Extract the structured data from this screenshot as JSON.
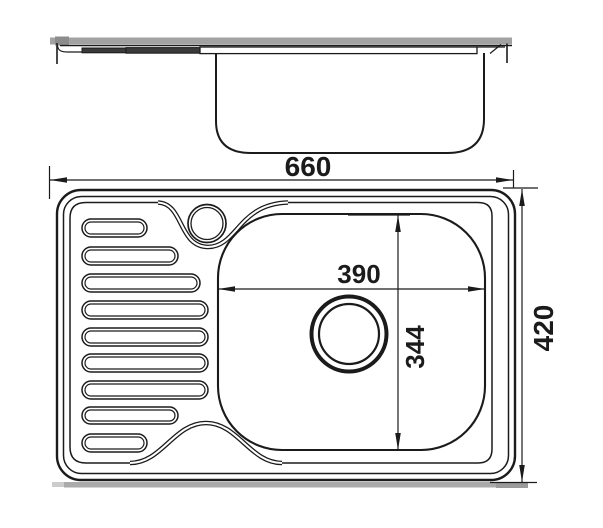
{
  "drawing": {
    "subject": "kitchen-sink-with-drainboard",
    "views": {
      "side_view": "sink profile with bowl cross-section",
      "top_view": "sink plan with drainboard, faucet hole and drain"
    },
    "dimensions": {
      "overall_width": "660",
      "overall_depth": "420",
      "bowl_width": "390",
      "bowl_depth": "344"
    },
    "colors": {
      "line": "#1b1b1b",
      "steel_shadow": "#aaaaaa",
      "shadow_light_cap": "#cccccc",
      "shadow_dark_cap": "#9a9a9a",
      "counter_band": "#a2a2a2",
      "counter_band_dark_cap": "#8c8c8c",
      "slot_profile_fill": "#3a3a3a",
      "background": "#ffffff"
    }
  }
}
